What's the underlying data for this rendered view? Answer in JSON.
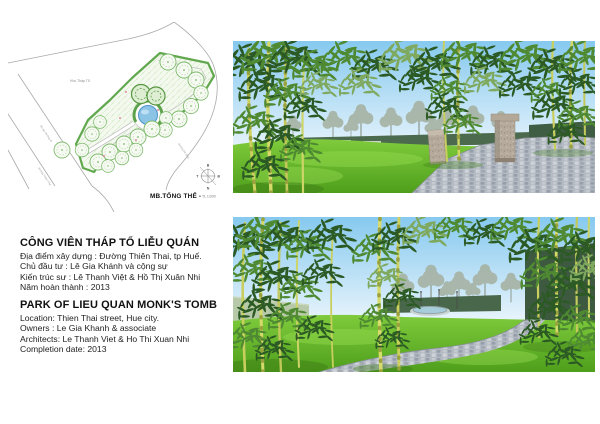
{
  "board": {
    "background": "#ffffff"
  },
  "plan": {
    "caption": "MB.TỔNG THỂ -",
    "caption_scale": "TL 1/200",
    "area_label": "Khu Tháp Tổ",
    "road_labels": {
      "upper_left": "lối vào đường đi",
      "lower_left": "đường Thiên Thai",
      "right": "đường bê tông"
    },
    "compass": {
      "north": "B",
      "east": "Đ",
      "south": "N",
      "west": "T"
    },
    "colors": {
      "boundary_green": "#62a84f",
      "tree_green": "#7cb96a",
      "pond_blue": "#8cc4e6",
      "road_gray": "#aaaaaa"
    }
  },
  "info_vi": {
    "title": "CÔNG VIÊN THÁP TỔ LIỄU QUÁN",
    "lines": [
      "Địa điểm xây dựng : Đường Thiên Thai, tp Huế.",
      "Chủ đầu tư : Lê Gia Khánh và cộng sự",
      "Kiến trúc sư : Lê Thanh Việt & Hồ Thị Xuân Nhi",
      "Năm hoàn thành : 2013"
    ]
  },
  "info_en": {
    "title": "PARK OF LIEU QUAN MONK'S TOMB",
    "lines": [
      "Location: Thien Thai street, Hue city.",
      "Owners : Le Gia Khanh & associate",
      "Architects: Le Thanh Viet & Ho Thi Xuan Nhi",
      "Completion date: 2013"
    ]
  },
  "renders": {
    "top": {
      "name": "perspective-entrance-view",
      "colors": {
        "sky": "#86c9ef",
        "lawn": "#6ab82a",
        "path": "#b4bac2",
        "bamboo": "#ccd05e"
      }
    },
    "bottom": {
      "name": "perspective-path-to-pond-view",
      "colors": {
        "sky": "#86c9ef",
        "lawn": "#6ab82a",
        "path": "#b4bac2",
        "pond": "#a5ccd8"
      }
    }
  }
}
